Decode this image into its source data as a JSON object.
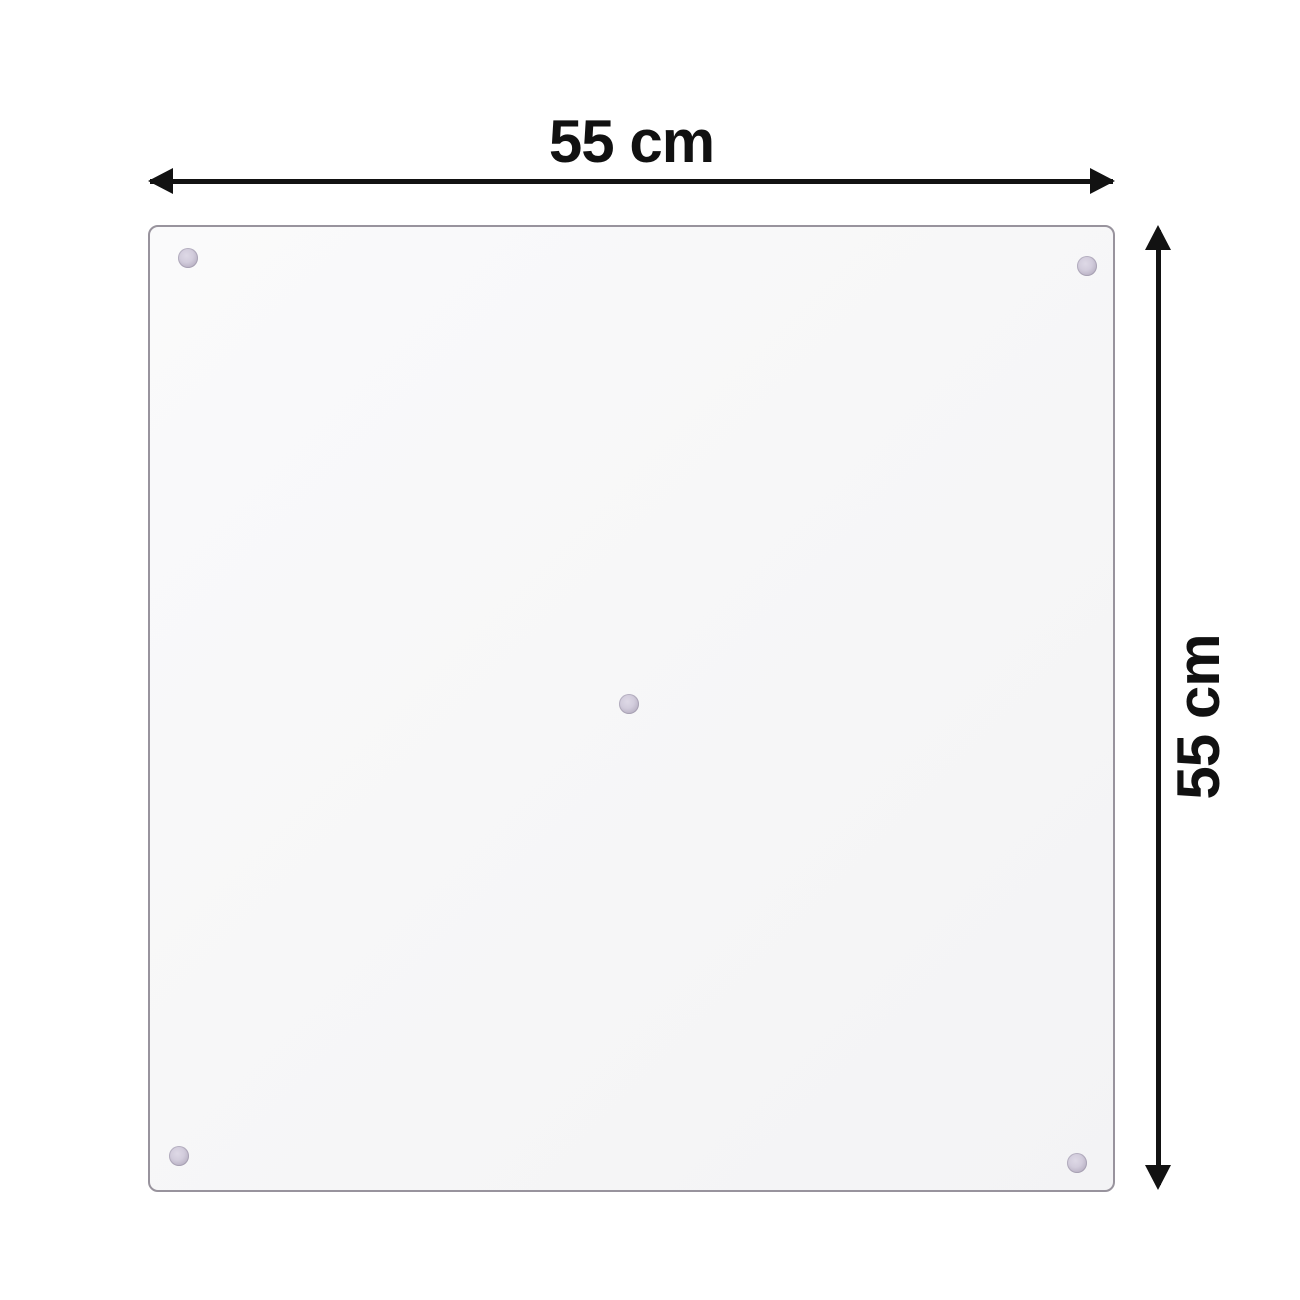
{
  "dimensions": {
    "width": {
      "label": "55 cm"
    },
    "height": {
      "label": "55 cm"
    }
  },
  "panel": {
    "shape": "square-glass-panel",
    "fasteners": [
      {
        "position": "top-left",
        "x": 188,
        "y": 258
      },
      {
        "position": "top-right",
        "x": 1087,
        "y": 266
      },
      {
        "position": "center",
        "x": 629,
        "y": 704
      },
      {
        "position": "bottom-left",
        "x": 179,
        "y": 1156
      },
      {
        "position": "bottom-right",
        "x": 1077,
        "y": 1163
      }
    ],
    "colors": {
      "panel_fill": "#f6f6f7",
      "panel_border": "#98939d",
      "fastener_outer": "#aba3b7",
      "fastener_inner": "#ded9e6",
      "arrow": "#121212",
      "label_text": "#111111",
      "background": "#ffffff"
    }
  }
}
